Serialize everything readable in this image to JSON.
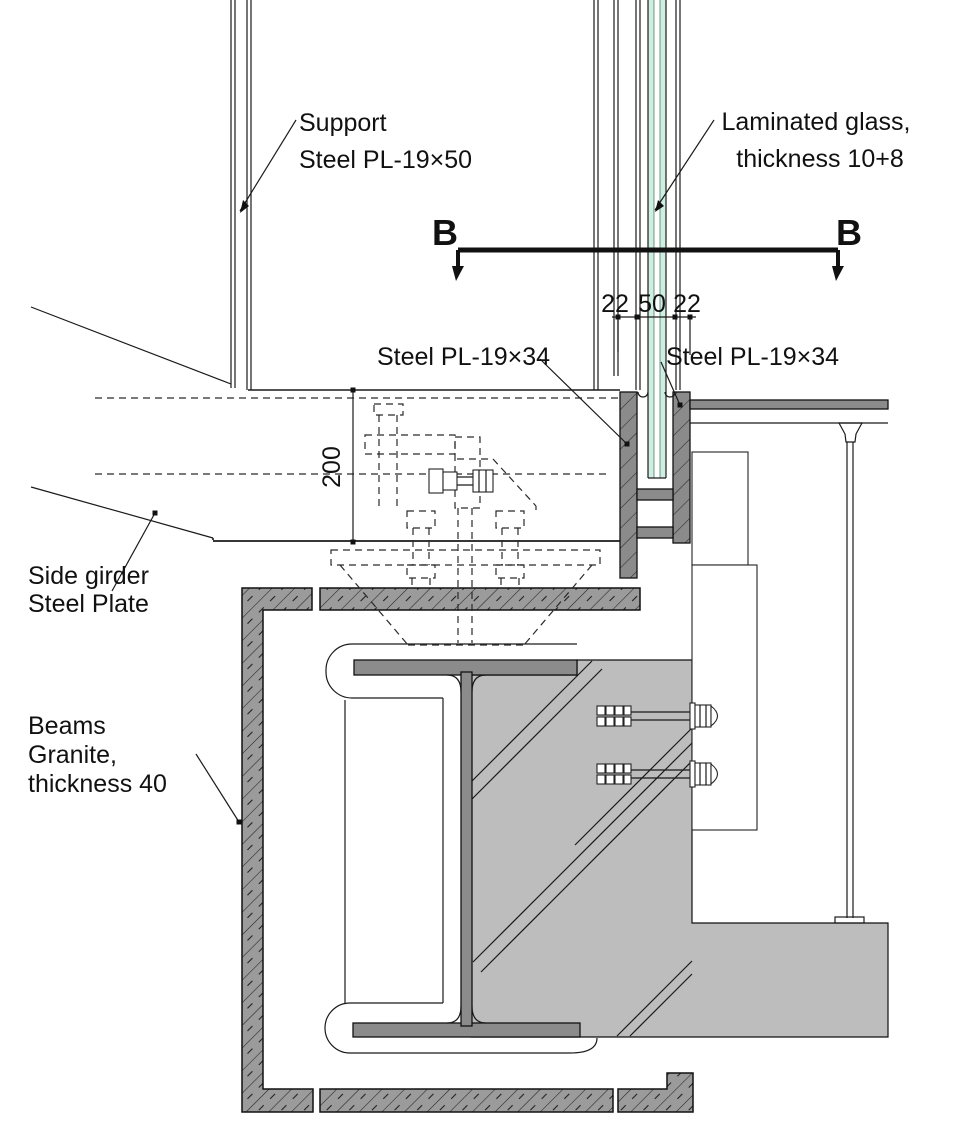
{
  "drawing": {
    "title_context": "Glass facade fixing detail at side girder",
    "labels": {
      "support_line1": "Support",
      "support_line2": "Steel PL-19×50",
      "glass_line1": "Laminated glass,",
      "glass_line2": "thickness 10+8",
      "plate_left": "Steel PL-19×34",
      "plate_right": "Steel PL-19×34",
      "side_girder_line1": "Side girder",
      "side_girder_line2": "Steel Plate",
      "beams_line1": "Beams",
      "beams_line2": "Granite,",
      "beams_line3": "thickness 40"
    },
    "section_markers": {
      "left": "B",
      "right": "B"
    },
    "dimensions": {
      "gap_left": "22",
      "glass_unit": "50",
      "gap_right": "22",
      "girder_height": "200"
    },
    "colors": {
      "steel": "#8b8b8b",
      "granite": "#9b9b9b",
      "concrete": "#bdbdbd",
      "glass": "#cfeee2",
      "glassEdge": "#3a6a5a",
      "line": "#1a1a1a",
      "background": "#ffffff"
    }
  }
}
